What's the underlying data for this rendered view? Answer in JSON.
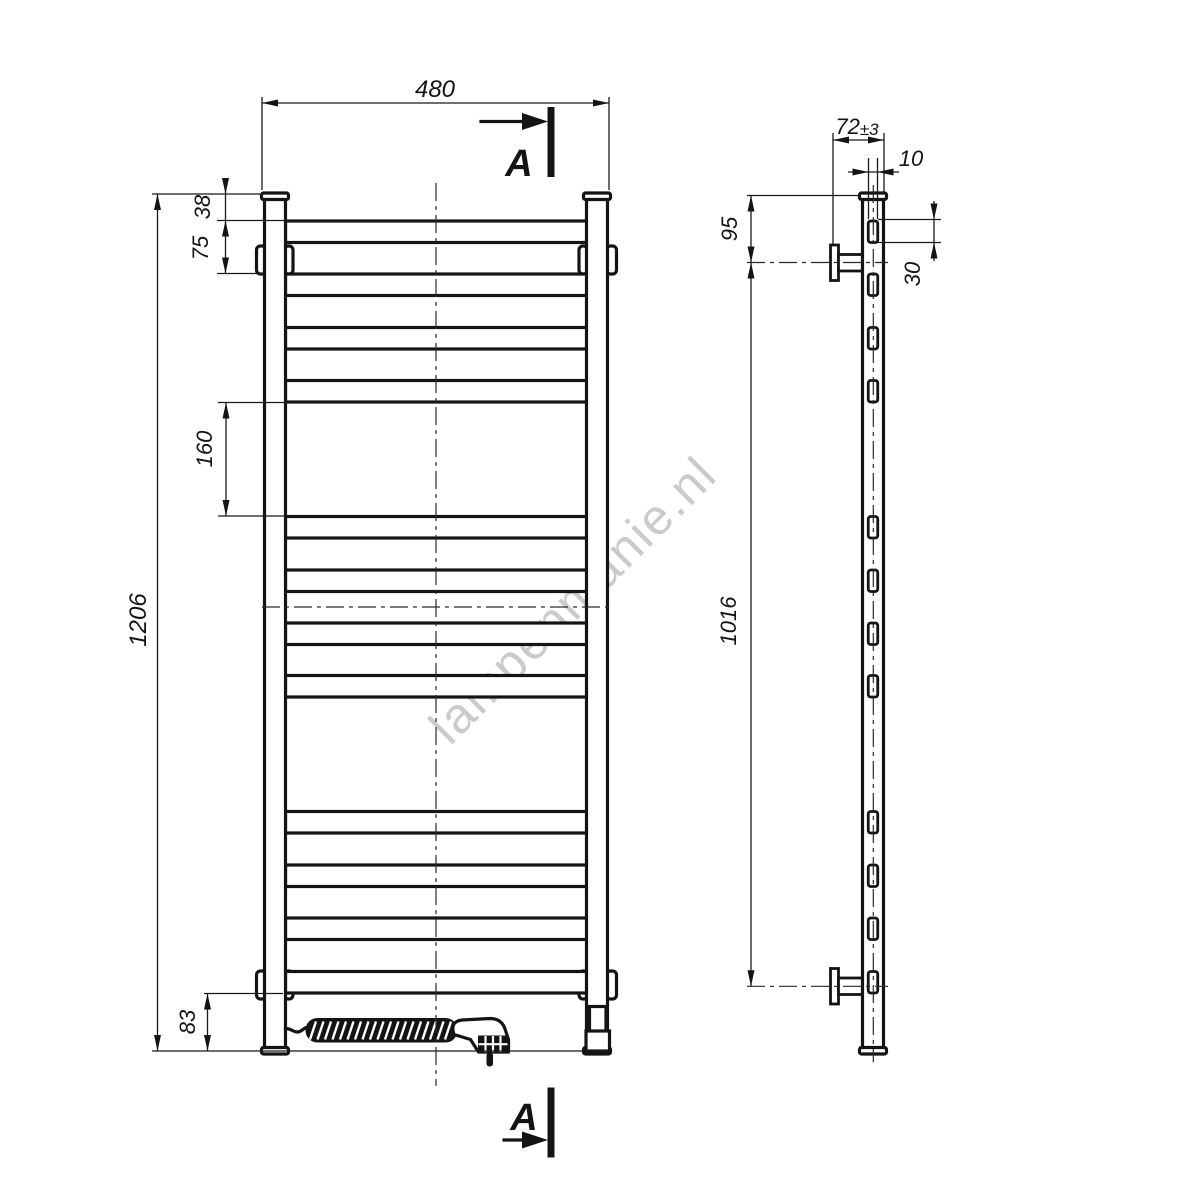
{
  "watermark": {
    "text": "lampenmanie.nl"
  },
  "section_marker": {
    "label": "A"
  },
  "front_view": {
    "rail_count": 12,
    "dims": {
      "overall_width": "480",
      "overall_height": "1206",
      "top_to_first_rail": "38",
      "rail_pitch": "75",
      "middle_gap": "160",
      "bottom_offset": "83"
    }
  },
  "side_view": {
    "dims": {
      "depth_value": "72",
      "depth_tolerance": "±3",
      "rail_thickness": "10",
      "top_to_bracket": "95",
      "rail_section_height": "30",
      "bracket_spacing": "1016"
    }
  },
  "colors": {
    "line": "#141414",
    "watermark": "#c3c3c3",
    "background": "#ffffff"
  }
}
